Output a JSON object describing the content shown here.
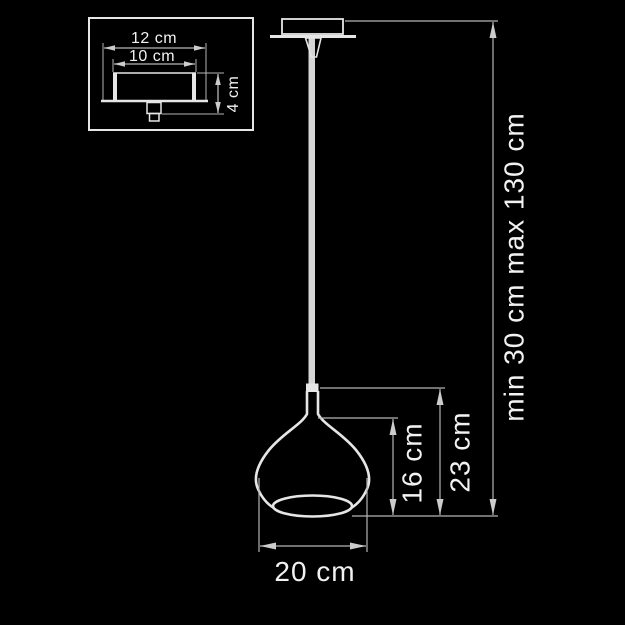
{
  "palette": {
    "background": "#000000",
    "object_stroke": "#e6e6e6",
    "dimension_stroke": "#b5b5b5",
    "text_color": "#f2f2f2",
    "cord_fill": "#d6d6d6"
  },
  "inset": {
    "outer_width_label": "12 cm",
    "inner_width_label": "10 cm",
    "height_label": "4 cm"
  },
  "main": {
    "diameter_label": "20 cm",
    "glass_body_height_label": "16 cm",
    "shade_total_height_label": "23 cm",
    "hanging_range_label": "min 30 cm  max 130 cm"
  }
}
